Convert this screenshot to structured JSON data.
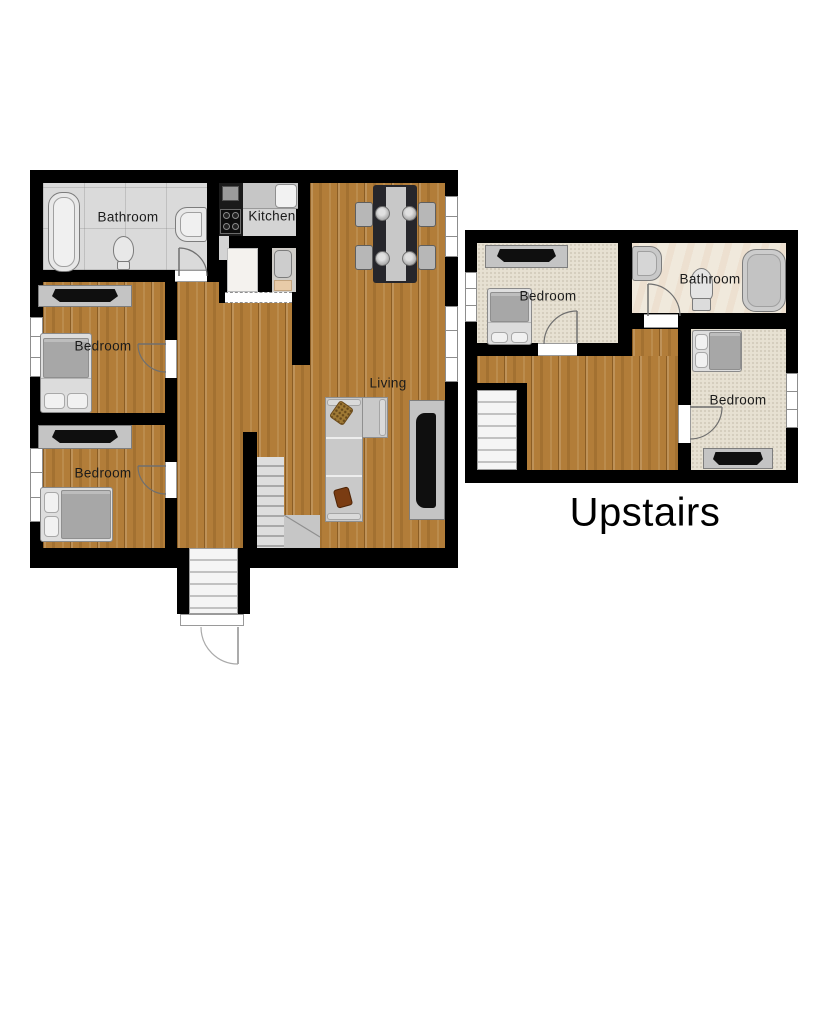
{
  "floor_plan": {
    "main_floor": {
      "bathroom_label": "Bathroom",
      "kitchen_label": "Kitchen",
      "bedroom_top_label": "Bedroom",
      "bedroom_bottom_label": "Bedroom",
      "living_label": "Living"
    },
    "upstairs": {
      "title": "Upstairs",
      "bedroom_left_label": "Bedroom",
      "bathroom_label": "Bathroom",
      "bedroom_right_label": "Bedroom"
    }
  },
  "colors": {
    "wall": "#000000",
    "wood_floor": "#b27d39",
    "carpet": "#e7e1d2",
    "tile_floor": "#dadada",
    "upstairs_bath_floor": "#f0e9dc",
    "fixture": "#e8e8e8",
    "furniture": "#c4c4c4",
    "tv": "#0f0f0f",
    "sofa": "#c9c9c9",
    "pillow_brown": "#7a3c12",
    "pillow_gold": "#a07a35"
  }
}
